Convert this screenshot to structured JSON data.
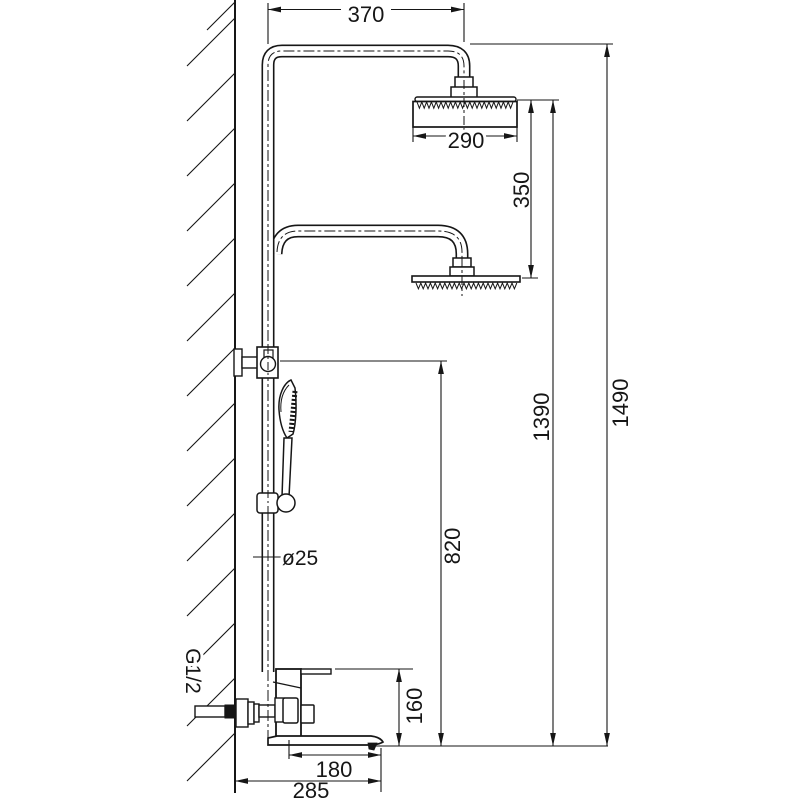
{
  "drawing": {
    "type": "installation-dimension-drawing",
    "subject": "wall-mounted dual rain shower column with hand shower and tub spout mixer",
    "units": "mm",
    "background": "#ffffff",
    "line_color": "#161616",
    "dimensions": {
      "arm_reach": "370",
      "head_width": "290",
      "head_gap": "350",
      "overall_height": "1490",
      "rain_head_height": "1390",
      "diverter_height": "820",
      "pipe_diameter": "ø25",
      "inlet_thread": "G1/2",
      "spout_drop": "160",
      "spout_reach": "180",
      "overall_reach": "285"
    },
    "parts": [
      "wall",
      "riser-pipe",
      "upper-shower-arm",
      "upper-rain-head",
      "lower-shower-arm",
      "lower-rain-head",
      "hand-shower",
      "slide-holder",
      "wall-diverter",
      "mixer-valve",
      "tub-spout",
      "wall-inlet"
    ]
  }
}
